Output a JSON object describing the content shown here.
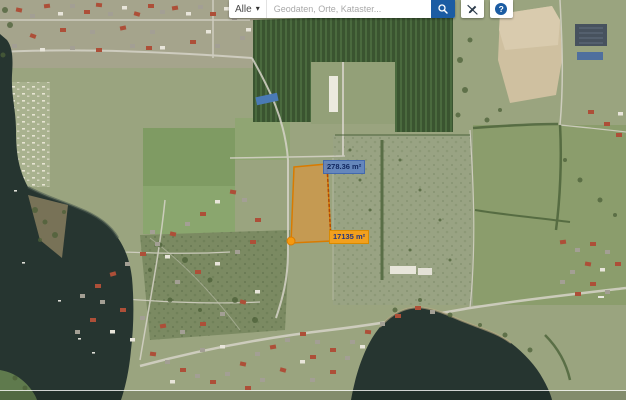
{
  "topbar": {
    "category_dropdown": {
      "value": "Alle",
      "caret": "▾"
    },
    "search": {
      "placeholder": "Geodaten, Orte, Kataster...",
      "value": ""
    },
    "search_button_icon": "magnifier",
    "draw_button_icon": "pen-slash",
    "help_button": {
      "label": "?"
    }
  },
  "map": {
    "type": "aerial-satellite",
    "measurements": [
      {
        "label": "278.36 m²",
        "style": "blue-highlight"
      },
      {
        "label": "17135 m²",
        "style": "orange"
      }
    ],
    "colors": {
      "accent_blue": "#1b5ca3",
      "parcel_orange": "#e9912d",
      "parcel_border": "#d97b00",
      "label_blue_bg": "#5d83c4",
      "label_orange_bg": "#f2a01d",
      "water": "#263530",
      "tan_field": "#cfc0a0",
      "orchard_green": "#3a5430"
    }
  }
}
